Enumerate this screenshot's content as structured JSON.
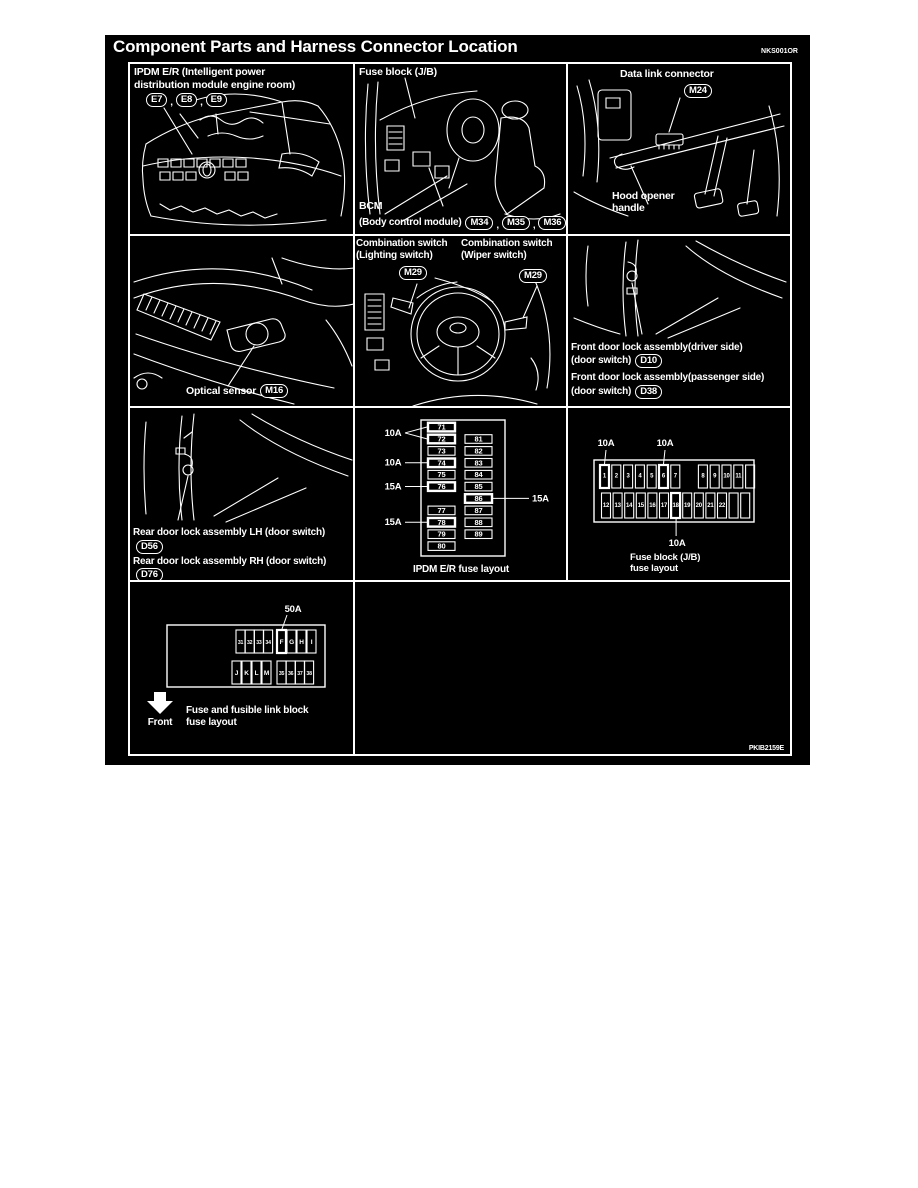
{
  "page": {
    "title": "Component Parts and Harness Connector Location",
    "code_top_right": "NKS001OR",
    "code_bottom_right": "PKIB2159E"
  },
  "colors": {
    "page_bg": "#ffffff",
    "panel_bg": "#000000",
    "line": "#ffffff"
  },
  "panels": {
    "ipdm_er": {
      "label_line1": "IPDM E/R (Intelligent power",
      "label_line2": "distribution module engine room)",
      "connectors": [
        "E7",
        "E8",
        "E9"
      ]
    },
    "fuse_block_interior": {
      "label": "Fuse block (J/B)",
      "bcm_label": "BCM",
      "bcm_sub_label": "(Body control module)",
      "bcm_connectors": [
        "M34",
        "M35",
        "M36"
      ]
    },
    "data_link": {
      "label": "Data link connector",
      "connector": "M24",
      "hood_label_line1": "Hood opener",
      "hood_label_line2": "handle"
    },
    "optical_sensor": {
      "label": "Optical sensor",
      "connector": "M16"
    },
    "combination_switch": {
      "lighting_line1": "Combination switch",
      "lighting_line2": "(Lighting switch)",
      "lighting_connector": "M29",
      "wiper_line1": "Combination switch",
      "wiper_line2": "(Wiper switch)",
      "wiper_connector": "M29"
    },
    "front_door_lock": {
      "driver_label": "Front door lock assembly(driver side)",
      "driver_sub": "(door switch)",
      "driver_connector": "D10",
      "passenger_label": "Front door lock assembly(passenger side)",
      "passenger_sub": "(door switch)",
      "passenger_connector": "D38"
    },
    "rear_door_lock": {
      "lh_label": "Rear door lock assembly LH (door switch)",
      "lh_connector": "D56",
      "rh_label": "Rear door lock assembly RH (door switch)",
      "rh_connector": "D76"
    },
    "ipdm_fuse_layout": {
      "caption": "IPDM E/R fuse layout",
      "rows": [
        [
          "71",
          null
        ],
        [
          "72",
          "81"
        ],
        [
          "73",
          "82"
        ],
        [
          "74",
          "83"
        ],
        [
          "75",
          "84"
        ],
        [
          "76",
          "85"
        ],
        [
          null,
          "86"
        ],
        [
          "77",
          "87"
        ],
        [
          "78",
          "88"
        ],
        [
          "79",
          "89"
        ],
        [
          "80",
          null
        ]
      ],
      "bold": [
        "71",
        "72",
        "74",
        "76",
        "78",
        "86"
      ],
      "amp_labels": [
        {
          "text": "10A",
          "side": "left",
          "targets": [
            "71",
            "72"
          ]
        },
        {
          "text": "10A",
          "side": "left",
          "targets": [
            "74"
          ]
        },
        {
          "text": "15A",
          "side": "left",
          "targets": [
            "76"
          ]
        },
        {
          "text": "15A",
          "side": "left",
          "targets": [
            "78"
          ]
        },
        {
          "text": "15A",
          "side": "right",
          "targets": [
            "86"
          ]
        }
      ]
    },
    "jb_fuse_layout": {
      "caption_line1": "Fuse block (J/B)",
      "caption_line2": "fuse layout",
      "top_row": [
        "1",
        "2",
        "3",
        "4",
        "5",
        "6",
        "7",
        null,
        "8",
        "9",
        "10",
        "11",
        ""
      ],
      "bottom_row": [
        "12",
        "13",
        "14",
        "15",
        "16",
        "17",
        "18",
        "19",
        "20",
        "21",
        "22",
        "",
        ""
      ],
      "bold": [
        "1",
        "6",
        "18"
      ],
      "amp_labels": [
        {
          "text": "10A",
          "pos": "above",
          "target": "1"
        },
        {
          "text": "10A",
          "pos": "above",
          "target": "6"
        },
        {
          "text": "10A",
          "pos": "below",
          "target": "18"
        }
      ]
    },
    "fusible_link_layout": {
      "caption_line1": "Fuse and fusible link block",
      "caption_line2": "fuse layout",
      "front_label": "Front",
      "amp_label": "50A",
      "amp_target": "F",
      "top_left_group": [
        "31",
        "32",
        "33",
        "34"
      ],
      "top_right_group": [
        "F",
        "G",
        "H",
        "I"
      ],
      "bottom_left_group": [
        "J",
        "K",
        "L",
        "M"
      ],
      "bottom_right_group": [
        "35",
        "36",
        "37",
        "38"
      ],
      "bold": [
        "F"
      ]
    }
  }
}
